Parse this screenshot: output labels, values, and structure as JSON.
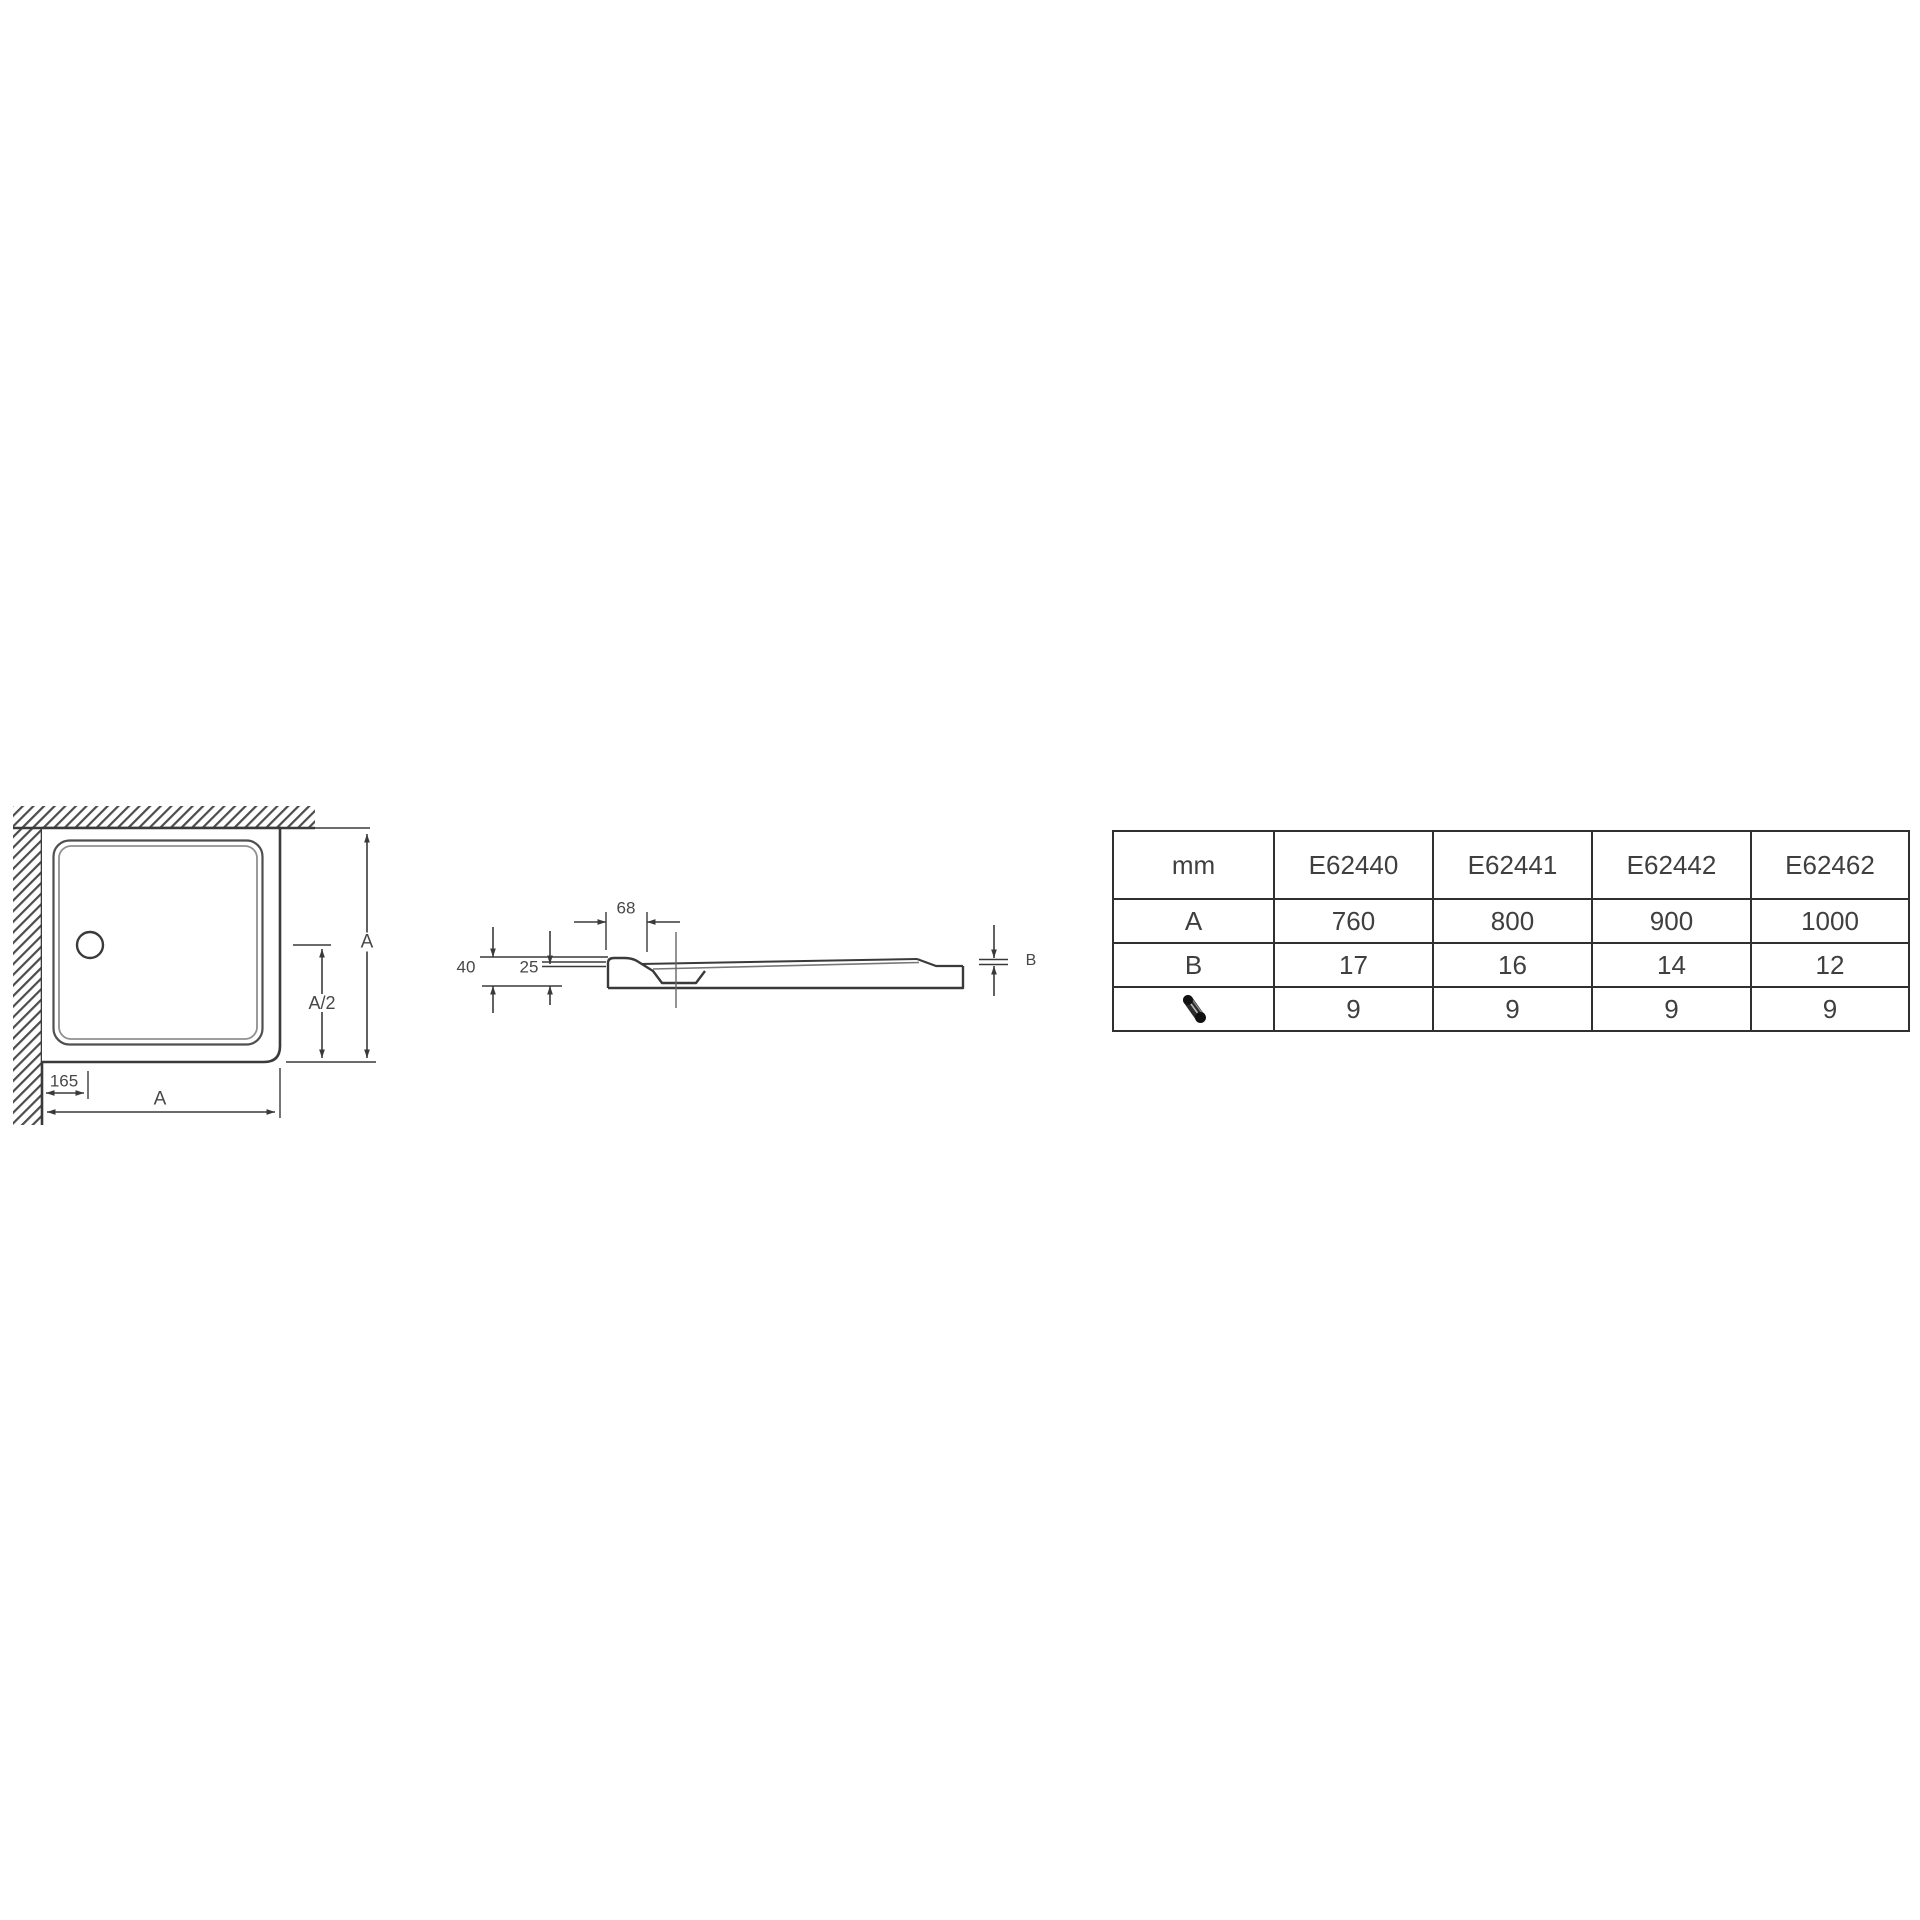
{
  "plan_view": {
    "dim_side": "A",
    "dim_half": "A/2",
    "dim_drain_offset": "165",
    "dim_width": "A"
  },
  "section_view": {
    "dim_rim_width": "68",
    "dim_total_height": "40",
    "dim_base_height": "25",
    "dim_edge_height": "B"
  },
  "table": {
    "unit_header": "mm",
    "columns": [
      "E62440",
      "E62441",
      "E62442",
      "E62462"
    ],
    "rows": [
      {
        "label": "A",
        "values": [
          "760",
          "800",
          "900",
          "1000"
        ]
      },
      {
        "label": "B",
        "values": [
          "17",
          "16",
          "14",
          "12"
        ]
      },
      {
        "label": "",
        "icon": "drain-waste-icon",
        "values": [
          "9",
          "9",
          "9",
          "9"
        ]
      }
    ]
  },
  "icons": {
    "row3_label": "drain-waste-icon"
  },
  "colors": {
    "line": "#3a3a3a",
    "light_line": "#8a8a8a",
    "table_border": "#303030",
    "text": "#474747"
  }
}
